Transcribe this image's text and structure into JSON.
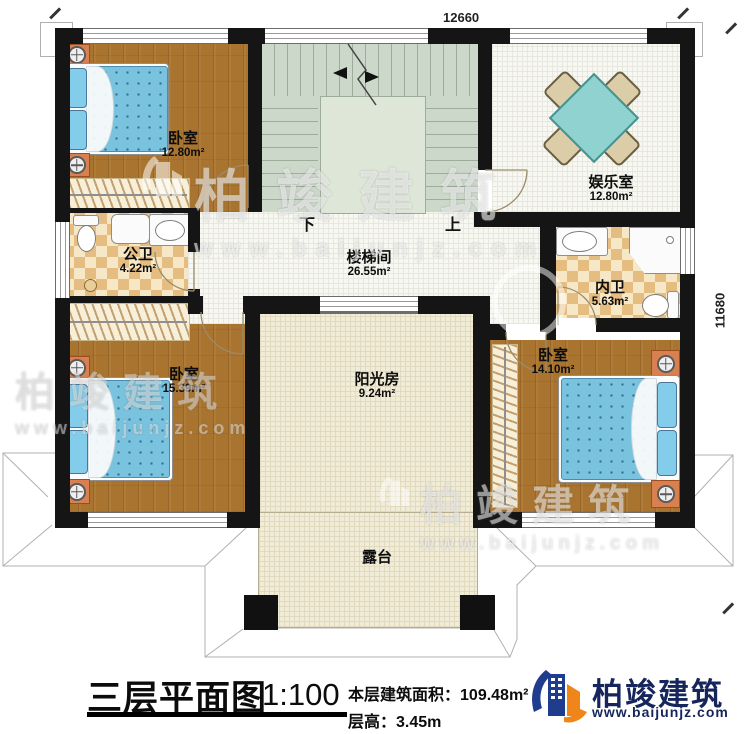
{
  "plan": {
    "title": "三层平面图",
    "scale": "1:100",
    "stats": {
      "area_label": "本层建筑面积：",
      "area_value": "109.48m²",
      "height_label": "层高：",
      "height_value": "3.45m"
    },
    "dimensions": {
      "top": "12660",
      "right": "11680"
    },
    "stair": {
      "down": "下",
      "up": "上"
    },
    "rooms": [
      {
        "id": "bedroom-nw",
        "name": "卧室",
        "area": "12.80m²"
      },
      {
        "id": "entertainment-room",
        "name": "娱乐室",
        "area": "12.80m²"
      },
      {
        "id": "public-bathroom",
        "name": "公卫",
        "area": "4.22m²"
      },
      {
        "id": "stair-hall",
        "name": "楼梯间",
        "area": "26.55m²"
      },
      {
        "id": "private-bathroom",
        "name": "内卫",
        "area": "5.63m²"
      },
      {
        "id": "bedroom-sw",
        "name": "卧室",
        "area": "15.39m²"
      },
      {
        "id": "sunroom",
        "name": "阳光房",
        "area": "9.24m²"
      },
      {
        "id": "bedroom-se",
        "name": "卧室",
        "area": "14.10m²"
      },
      {
        "id": "terrace",
        "name": "露台",
        "area": ""
      }
    ]
  },
  "branding": {
    "company": "柏竣建筑",
    "website": "www.baijunjz.com"
  },
  "colors": {
    "wall": "#151515",
    "wood": "#a9742f",
    "stair_green": "#ccd8ca",
    "mattress_blue": "#79c3de",
    "logo_blue": "#1f3d8c",
    "logo_orange": "#f08619"
  }
}
